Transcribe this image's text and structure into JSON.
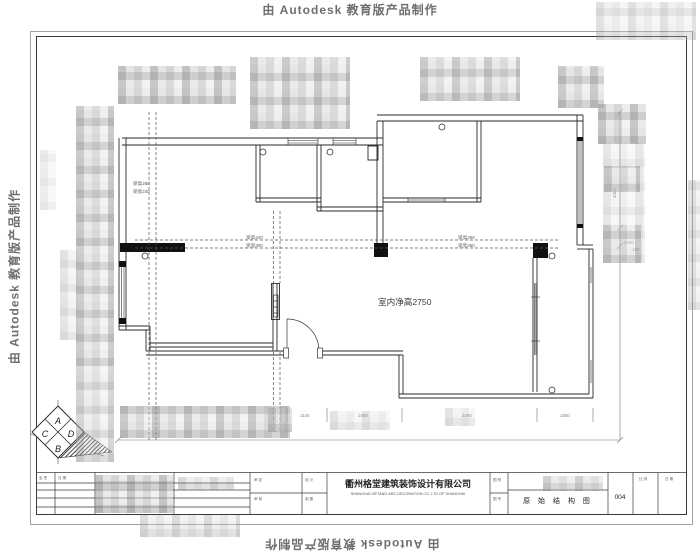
{
  "watermark": {
    "text": "由 Autodesk 教育版产品制作"
  },
  "plan": {
    "ceiling_height_label": "室内净高2750",
    "beam_labels": {
      "left_line1": "梁高260",
      "left_line2": "梁宽240",
      "mid_line1": "梁高240",
      "mid_line2": "梁宽300",
      "right_line1": "梁高250",
      "right_line2": "梁宽250"
    },
    "dimensions": {
      "bottom": [
        "1140",
        "1500",
        "3280",
        "1500"
      ],
      "right_rotated": "4300",
      "right_a": "2300",
      "right_b": "150"
    }
  },
  "logo": {
    "letters": [
      "A",
      "D",
      "B",
      "C"
    ]
  },
  "title_block": {
    "company_cn": "衢州格堂建筑装饰设计有限公司",
    "company_en": "SHANGHAI GETANG ARC DECORATION CO. LTD OF SHANGHAI",
    "drawing_title": "原 始 结 构 图",
    "drawing_number": "004",
    "small_labels": {
      "a": "会 签",
      "b": "日 期",
      "c": "审 定",
      "d": "审 核",
      "e": "设 计",
      "f": "制 图",
      "g": "图 别",
      "h": "图 号",
      "i": "比 例",
      "j": "日 期"
    }
  },
  "colors": {
    "line": "#2a2a2a",
    "dash": "#555555",
    "dim": "#777777"
  }
}
